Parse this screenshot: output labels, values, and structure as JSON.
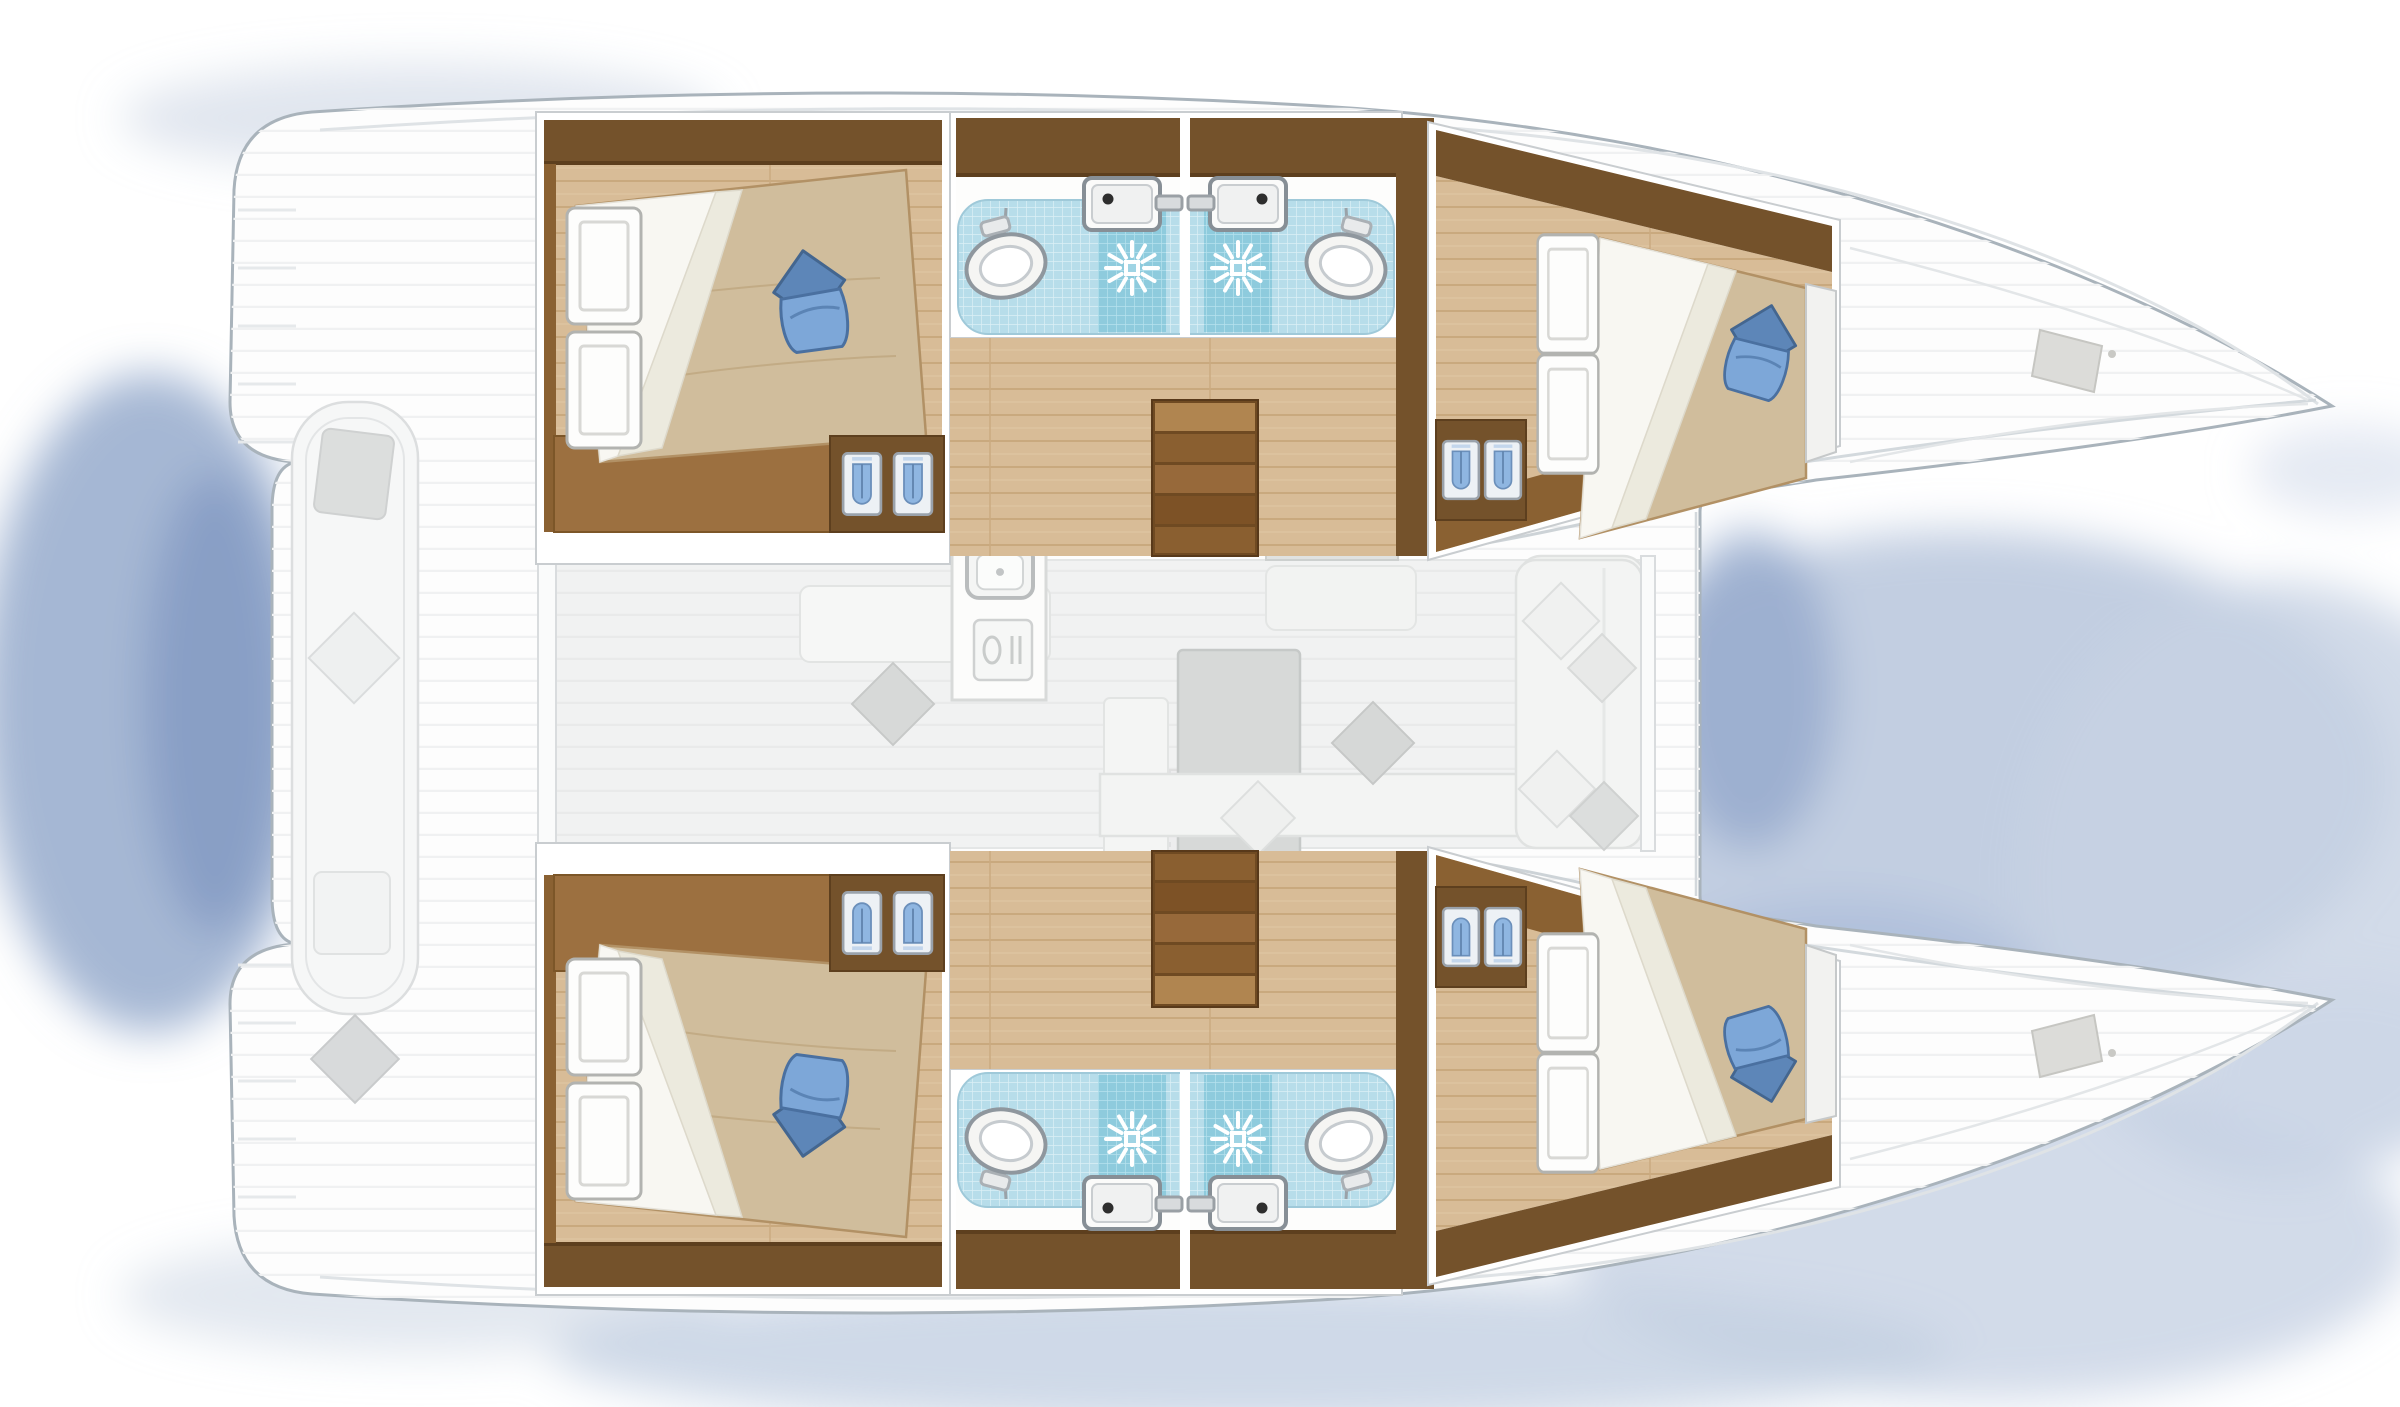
{
  "diagram": {
    "type": "yacht-floor-plan",
    "vessel": {
      "kind": "catamaran",
      "view": "top-down deck and accommodation plan",
      "orientation": "bows-right",
      "cabins": 4,
      "heads": 4,
      "text_labels": []
    },
    "palette": {
      "background": "#ffffff",
      "hull_outline": "#a9b3bb",
      "deck_white": "#fdfdfd",
      "deck_streak": "#f0f1f2",
      "saloon_floor": "#f1f2f2",
      "furniture_gray": "#d7d9d8",
      "wood_wall_dark": "#74522b",
      "wood_mid": "#9c7040",
      "wood_step": "#8a6132",
      "wood_floor": "#d8bc97",
      "wood_floor_line": "#c9a97e",
      "bed_duvet": "#d0bd9c",
      "sheet_white": "#f8f7f2",
      "pillow_blue": "#7da7d8",
      "pillow_blue_dark": "#4a70a0",
      "tile_light": "#b7ddea",
      "tile_shower": "#8ecbdd",
      "locker_blue": "#8fb6e1",
      "shadow_water": "#9fb2d2"
    },
    "areas": [
      {
        "id": "aft-cockpit",
        "label": "aft cockpit",
        "furniture": [
          "bench-seat",
          "seat-cushions",
          "transom-steps"
        ]
      },
      {
        "id": "saloon",
        "label": "saloon and galley",
        "furniture": [
          "galley-counter",
          "double-galley-sink",
          "stove-4-burner",
          "cutlery-drawer",
          "dinette-table",
          "settee-l-shaped",
          "chaise-seat",
          "scatter-cushions",
          "rug",
          "nav-seat",
          "companionway-steps-port",
          "companionway-steps-starboard",
          "windshield"
        ]
      },
      {
        "id": "port-aft-cabin",
        "label": "port aft cabin",
        "furniture": [
          "double-bed",
          "blue-pillow",
          "folded-sheet",
          "wardrobe",
          "storage-lockers"
        ]
      },
      {
        "id": "port-aft-head",
        "label": "port aft head",
        "fixtures": [
          "toilet",
          "washbasin",
          "shower-with-drain"
        ]
      },
      {
        "id": "port-forward-head",
        "label": "port forward head",
        "fixtures": [
          "toilet",
          "washbasin",
          "shower-with-drain"
        ]
      },
      {
        "id": "port-forward-cabin",
        "label": "port forward cabin",
        "furniture": [
          "double-bed",
          "blue-pillow",
          "folded-sheet",
          "wardrobe",
          "storage-lockers"
        ]
      },
      {
        "id": "port-forepeak",
        "label": "port bow storage",
        "features": [
          "deck-hatch"
        ]
      },
      {
        "id": "starboard-aft-cabin",
        "label": "starboard aft cabin",
        "furniture": [
          "double-bed",
          "blue-pillow",
          "folded-sheet",
          "wardrobe",
          "storage-lockers"
        ]
      },
      {
        "id": "starboard-aft-head",
        "label": "starboard aft head",
        "fixtures": [
          "toilet",
          "washbasin",
          "shower-with-drain"
        ]
      },
      {
        "id": "starboard-forward-head",
        "label": "starboard forward head",
        "fixtures": [
          "toilet",
          "washbasin",
          "shower-with-drain"
        ]
      },
      {
        "id": "starboard-forward-cabin",
        "label": "starboard forward cabin",
        "furniture": [
          "double-bed",
          "blue-pillow",
          "folded-sheet",
          "wardrobe",
          "storage-lockers"
        ]
      },
      {
        "id": "starboard-forepeak",
        "label": "starboard bow storage",
        "features": [
          "deck-hatch"
        ]
      },
      {
        "id": "water-shadow",
        "label": "soft water shadow between bows, aft notch and under hulls"
      }
    ]
  }
}
